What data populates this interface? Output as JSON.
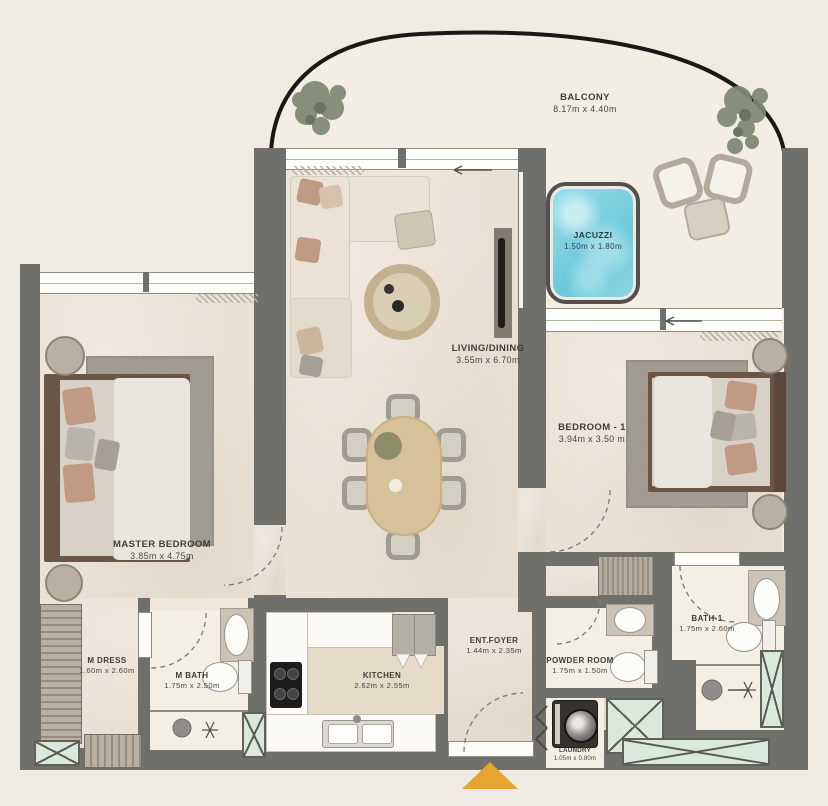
{
  "rooms": {
    "balcony": {
      "name": "BALCONY",
      "dims": "8.17m x 4.40m"
    },
    "jacuzzi": {
      "name": "JACUZZI",
      "dims": "1.50m x 1.80m"
    },
    "living_dining": {
      "name": "LIVING/DINING",
      "dims": "3.55m x 6.70m"
    },
    "bedroom_1": {
      "name": "BEDROOM - 1",
      "dims": "3.94m x 3.50 m"
    },
    "master_bedroom": {
      "name": "MASTER BEDROOM",
      "dims": "3.85m x 4.75m"
    },
    "m_dress": {
      "name": "M DRESS",
      "dims": "1.60m x 2.60m"
    },
    "m_bath": {
      "name": "M BATH",
      "dims": "1.75m x 2.50m"
    },
    "kitchen": {
      "name": "KITCHEN",
      "dims": "2.62m x 2.55m"
    },
    "ent_foyer": {
      "name": "ENT.FOYER",
      "dims": "1.44m x 2.35m"
    },
    "powder_room": {
      "name": "POWDER ROOM",
      "dims": "1.75m x 1.50m"
    },
    "bath_1": {
      "name": "BATH-1",
      "dims": "1.75m x 2.60m"
    },
    "laundry": {
      "name": "LAUNDRY",
      "dims": "1.05m x 0.80m"
    }
  },
  "colors": {
    "wall": "#6f6f6c",
    "floor": "#e9e1d4",
    "balcony_floor": "#f2eee4",
    "bathroom_floor": "#f4efe4",
    "jacuzzi_water": "#7fd2e2",
    "mint_shaft": "#dbe9dd",
    "entry_arrow": "#e5a530",
    "label_text": "#3f3d38"
  }
}
